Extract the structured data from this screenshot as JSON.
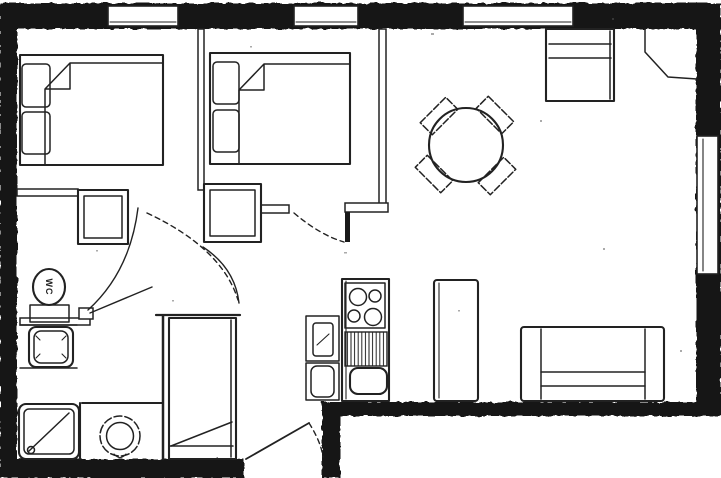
{
  "labels": {
    "wc": "WC"
  },
  "colors": {
    "background": "#ffffff",
    "wall": "#191919",
    "line": "#222222"
  },
  "fixtures": [
    "double-bed",
    "pillow",
    "blanket",
    "wardrobe",
    "window",
    "dining-table",
    "dining-chair",
    "sideboard",
    "tall-cabinet",
    "sofa",
    "stove-burners",
    "kitchen-counter-drainer",
    "kitchen-sink",
    "kitchen-appliance",
    "toilet-wc",
    "washbasin-vanity",
    "shower-tray",
    "washing-machine",
    "hall-closet",
    "door-swing",
    "entry-door",
    "corner-flue"
  ]
}
